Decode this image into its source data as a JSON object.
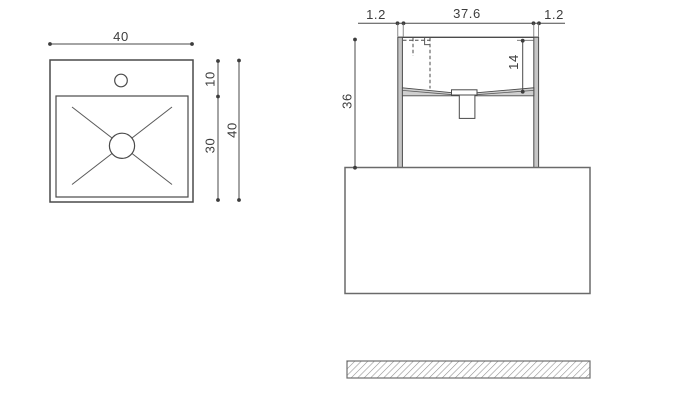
{
  "drawing": {
    "background": "#ffffff",
    "line_color": "#4a4a4a",
    "text_color": "#3d3d3d",
    "wall_fill_color": "#c6c6c6",
    "hatch_color": "#8f8f8f",
    "top_view": {
      "dim_overall_width": "40",
      "dim_deck_depth": "10",
      "dim_bowl_depth": "30",
      "dim_overall_depth": "40"
    },
    "front_view": {
      "dim_left_wall_thickness": "1.2",
      "dim_inner_width": "37.6",
      "dim_right_wall_thickness": "1.2",
      "dim_basin_height": "36",
      "dim_bowl_inner_depth": "14"
    }
  }
}
